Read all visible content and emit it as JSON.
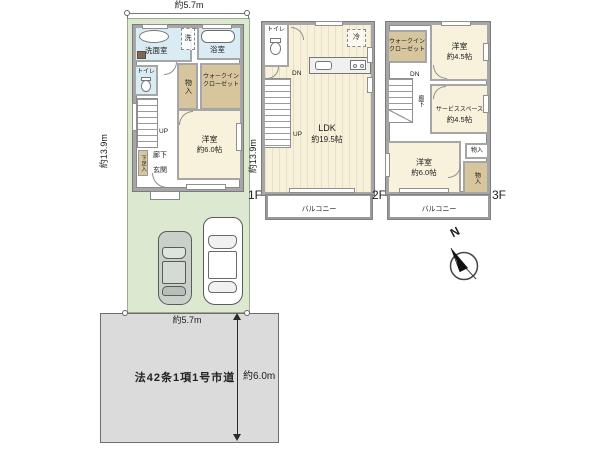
{
  "colors": {
    "lot_green": "#dde8d0",
    "road_gray": "#dbdbdb",
    "wall_gray": "#a6a6a6",
    "room_cream": "#f8f2dd",
    "closet_tan": "#d7c59d",
    "wet_blue": "#d9ecf3",
    "text": "#1c1c1c"
  },
  "dims": {
    "top_width": "約5.7m",
    "left_depth": "約13.9m",
    "right_depth": "約13.9m",
    "road_frontage": "約5.7m",
    "road_width": "約6.0m"
  },
  "road": {
    "name": "法42条1項1号市道"
  },
  "compass": {
    "north": "N"
  },
  "floor1": {
    "label": "1F",
    "washroom": "洗面室",
    "laundry": "洗",
    "bathroom": "浴室",
    "toilet": "トイレ",
    "storage": "物入",
    "wic_line1": "ウォークイン",
    "wic_line2": "クローゼット",
    "stairs_up": "UP",
    "shoe_closet": "下足入",
    "hallway": "廊下",
    "entrance": "玄関",
    "bedroom_name": "洋室",
    "bedroom_size": "約6.0帖"
  },
  "floor2": {
    "label": "2F",
    "toilet": "トイレ",
    "fridge": "冷",
    "stairs_dn": "DN",
    "stairs_up": "UP",
    "ldk_name": "LDK",
    "ldk_size": "約19.5帖",
    "balcony": "バルコニー"
  },
  "floor3": {
    "label": "3F",
    "wic_line1": "ウォークイン",
    "wic_line2": "クローゼット",
    "bedroom1_name": "洋室",
    "bedroom1_size": "約4.5帖",
    "stairs_dn": "DN",
    "hallway": "廊下",
    "service_name": "サービススペース",
    "service_size": "約4.5帖",
    "storage_a": "物入",
    "storage_b": "物入",
    "bedroom2_name": "洋室",
    "bedroom2_size": "約6.0帖",
    "balcony": "バルコニー"
  }
}
